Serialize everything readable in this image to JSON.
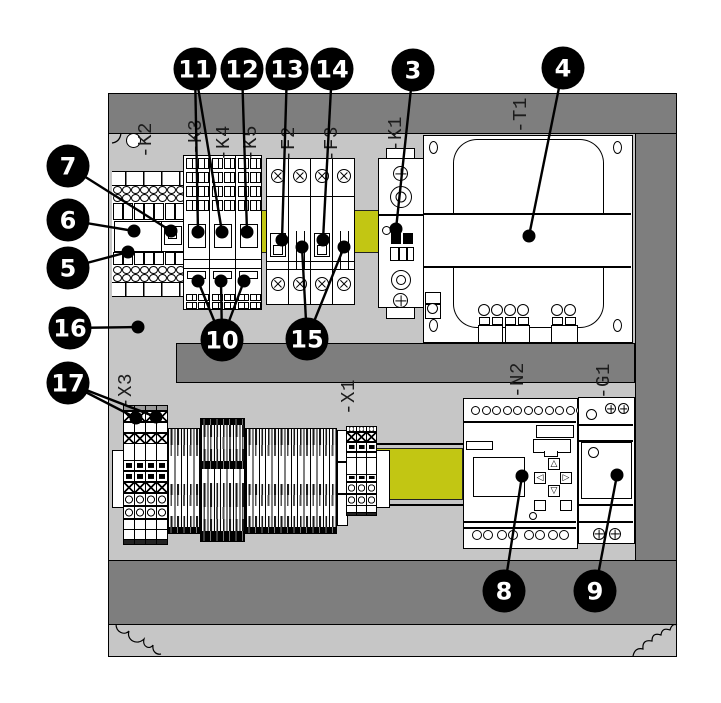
{
  "figure": {
    "kind": "control-cabinet-assembly-diagram",
    "background": "#ffffff"
  },
  "colors": {
    "frame_dark": "#7e7e7e",
    "mounting_plate": "#c6c6c6",
    "din_rail_yellow": "#c2c613",
    "outline": "#000000",
    "callout_bg": "#000000",
    "callout_text": "#ffffff"
  },
  "device_labels": [
    {
      "id": "k2",
      "text": "-K2",
      "x": 146,
      "y": 140
    },
    {
      "id": "k3",
      "text": "-K3",
      "x": 196,
      "y": 137
    },
    {
      "id": "k4",
      "text": "-K4",
      "x": 224,
      "y": 143
    },
    {
      "id": "k5",
      "text": "-K5",
      "x": 251,
      "y": 143
    },
    {
      "id": "f2",
      "text": "-F2",
      "x": 289,
      "y": 144
    },
    {
      "id": "f3",
      "text": "-F3",
      "x": 332,
      "y": 144
    },
    {
      "id": "k1",
      "text": "-K1",
      "x": 396,
      "y": 134
    },
    {
      "id": "t1",
      "text": "-T1",
      "x": 521,
      "y": 115
    },
    {
      "id": "n2",
      "text": "-N2",
      "x": 518,
      "y": 380
    },
    {
      "id": "g1",
      "text": "-G1",
      "x": 604,
      "y": 381
    },
    {
      "id": "x3",
      "text": "-X3",
      "x": 126,
      "y": 391
    },
    {
      "id": "x1",
      "text": "-X1",
      "x": 349,
      "y": 397
    }
  ],
  "callouts": [
    {
      "number": "3",
      "x": 413,
      "y": 70,
      "targets": [
        [
          396,
          229
        ]
      ]
    },
    {
      "number": "4",
      "x": 563,
      "y": 68,
      "targets": [
        [
          529,
          236
        ]
      ]
    },
    {
      "number": "5",
      "x": 68,
      "y": 268,
      "targets": [
        [
          128,
          252
        ]
      ]
    },
    {
      "number": "6",
      "x": 68,
      "y": 220,
      "targets": [
        [
          134,
          231
        ]
      ]
    },
    {
      "number": "7",
      "x": 68,
      "y": 166,
      "targets": [
        [
          171,
          231
        ]
      ]
    },
    {
      "number": "8",
      "x": 504,
      "y": 591,
      "targets": [
        [
          522,
          476
        ]
      ]
    },
    {
      "number": "9",
      "x": 595,
      "y": 591,
      "targets": [
        [
          617,
          475
        ]
      ]
    },
    {
      "number": "10",
      "x": 222,
      "y": 340,
      "targets": [
        [
          198,
          281
        ],
        [
          221,
          281
        ],
        [
          244,
          281
        ]
      ]
    },
    {
      "number": "11",
      "x": 195,
      "y": 69,
      "targets": [
        [
          198,
          232
        ],
        [
          222,
          232
        ]
      ]
    },
    {
      "number": "12",
      "x": 242,
      "y": 69,
      "targets": [
        [
          247,
          232
        ]
      ]
    },
    {
      "number": "13",
      "x": 287,
      "y": 69,
      "targets": [
        [
          282,
          240
        ]
      ]
    },
    {
      "number": "14",
      "x": 332,
      "y": 69,
      "targets": [
        [
          323,
          240
        ]
      ]
    },
    {
      "number": "15",
      "x": 307,
      "y": 339,
      "targets": [
        [
          302,
          247
        ],
        [
          344,
          247
        ]
      ]
    },
    {
      "number": "16",
      "x": 70,
      "y": 328,
      "targets": [
        [
          138,
          327
        ]
      ]
    },
    {
      "number": "17",
      "x": 68,
      "y": 383,
      "targets": [
        [
          136,
          418
        ],
        [
          156,
          417
        ]
      ]
    }
  ]
}
